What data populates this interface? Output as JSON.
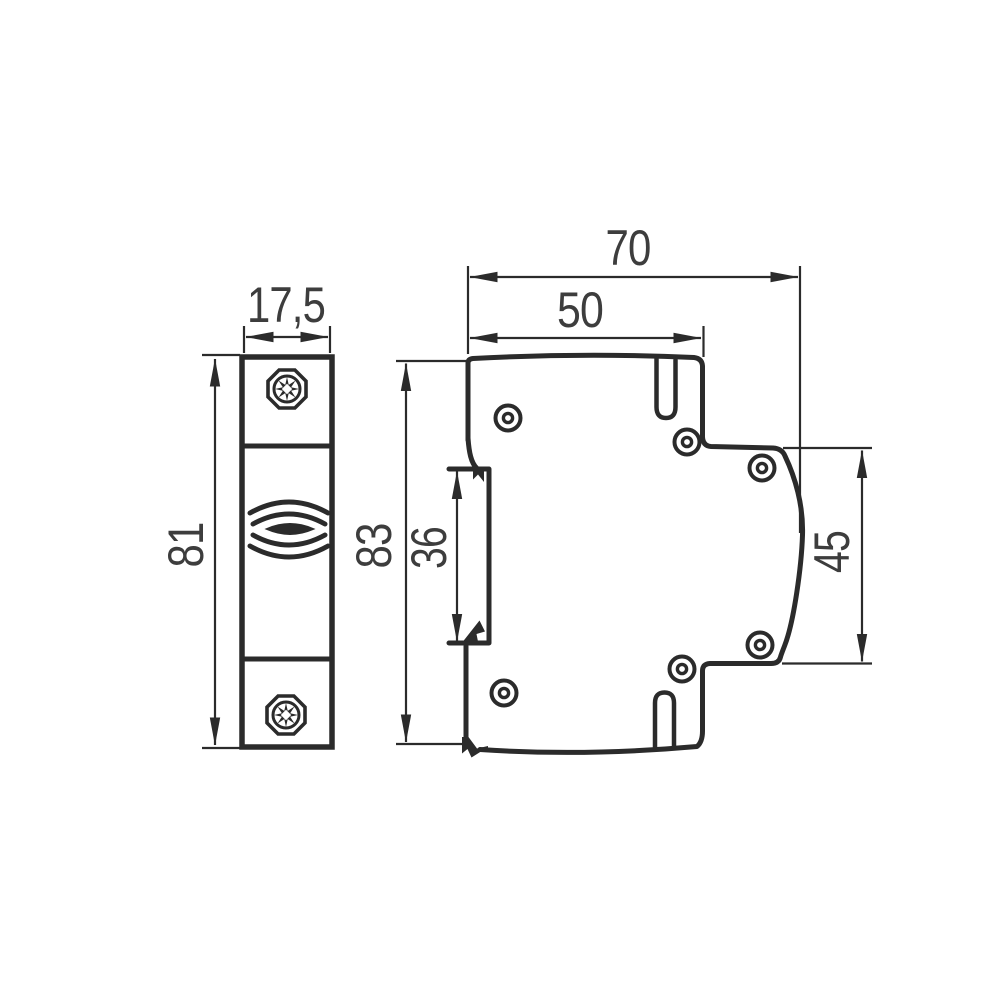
{
  "window": {
    "background": "#ffffff"
  },
  "drawing": {
    "type": "technical-dimension-drawing",
    "line_color": "#2b2b2b",
    "label_color": "#3d3d3d",
    "front_view": {
      "width_mm": "17,5",
      "height_mm": "81"
    },
    "side_view": {
      "overall_width_mm": "70",
      "upper_width_mm": "50",
      "overall_height_mm": "83",
      "din_recess_height_mm": "36",
      "right_edge_height_mm": "45"
    }
  }
}
